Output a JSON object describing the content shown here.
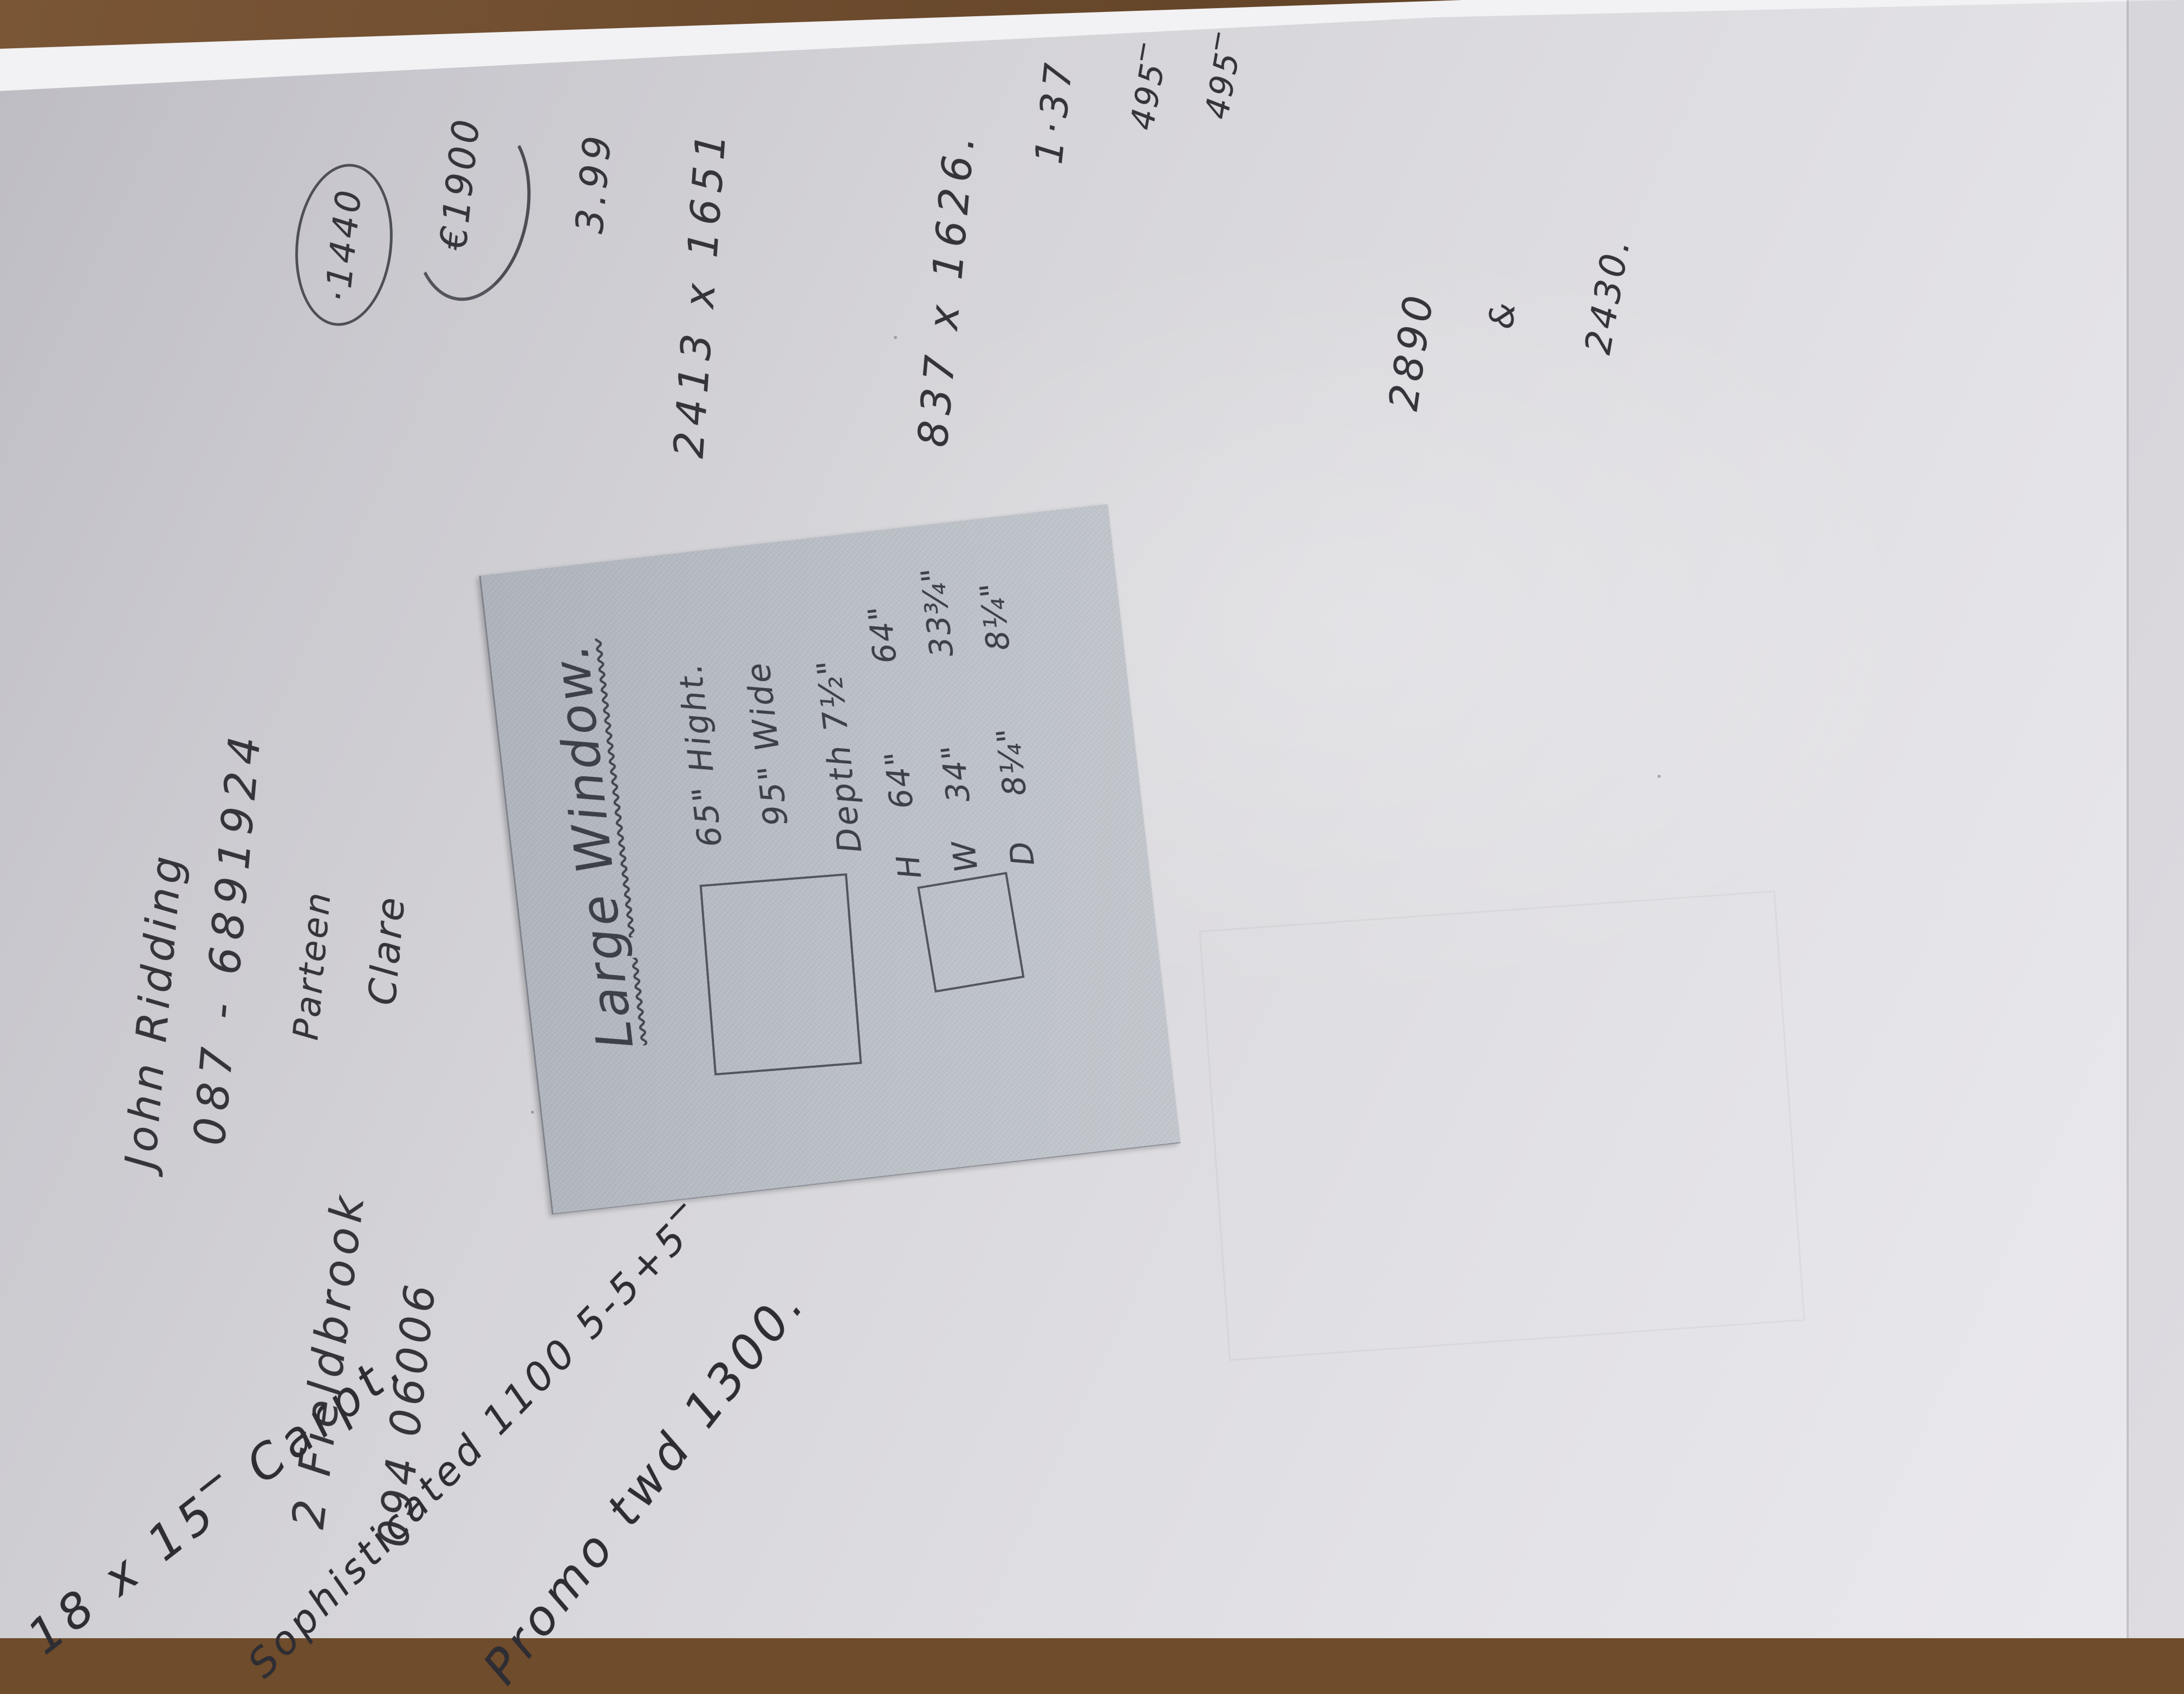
{
  "photo": {
    "paper_color": "#d7d6da",
    "ink_color": "#35343b",
    "note_color": "#b7bcc3",
    "wood_color": "#6e4c2c"
  },
  "contact": {
    "name": "John Ridding",
    "mobile": "087 - 6891924",
    "address_line": "2 Fieldbrook",
    "landline": "094 06006",
    "town": "Parteen",
    "county": "Clare"
  },
  "figures": {
    "quote_circled": "·1440",
    "quote_swoosh": "€1900",
    "rate": "3.99",
    "window_mm_large": "2413 x 1651",
    "window_mm_small": "837 x 1626.",
    "ratio": "1·37",
    "price_a": "495‾",
    "price_b": "495‾",
    "sum_a": "2890",
    "joiner": "&",
    "sum_b": "2430."
  },
  "note": {
    "title": "Large Window.",
    "specs": [
      "65\" Hight.",
      "95\" Wide",
      "Depth 7½\""
    ],
    "table": {
      "rows": [
        {
          "label": "H",
          "inner": "64\"",
          "outer": "64\""
        },
        {
          "label": "W",
          "inner": "34\"",
          "outer": "33¾\""
        },
        {
          "label": "D",
          "inner": "8¼\"",
          "outer": "8¼\""
        }
      ]
    }
  },
  "carpet_note": {
    "line1": "18 x 15‾ Carpt.",
    "line2": "Sophisticated 1100   5-5+5‾",
    "line3": "Promo twd 1300."
  }
}
